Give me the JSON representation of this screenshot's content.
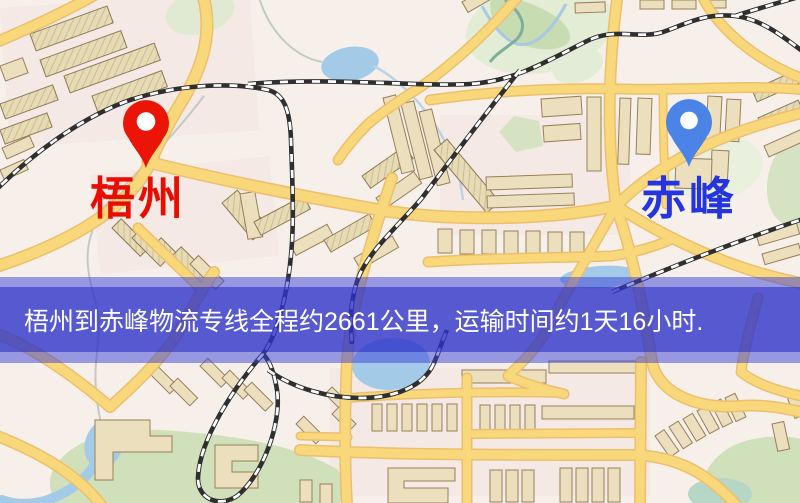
{
  "banner": {
    "text": "梧州到赤峰物流专线全程约2661公里，运输时间约1天16小时.",
    "overlay_color": "#3a40d7",
    "band_color": "#2b2fc4",
    "text_color": "#ffffff"
  },
  "markers": {
    "origin": {
      "label": "梧州",
      "pin_color": "#ea1407",
      "label_color": "#e90d00"
    },
    "destination": {
      "label": "赤峰",
      "pin_color": "#4b84e6",
      "label_color": "#2434de"
    }
  },
  "route": {
    "from": "梧州",
    "to": "赤峰",
    "service": "物流专线",
    "distance_text": "约2661公里",
    "duration_text": "约1天16小时",
    "distance_km": 2661
  },
  "map_colors": {
    "background": "#f7f0ea",
    "road": "#f9d87c",
    "road_casing": "#ecbf6d",
    "building": "#ecdfbd",
    "park": "#cfe0ba",
    "water": "#a3cbe8",
    "railway": "#2f2f2f"
  }
}
